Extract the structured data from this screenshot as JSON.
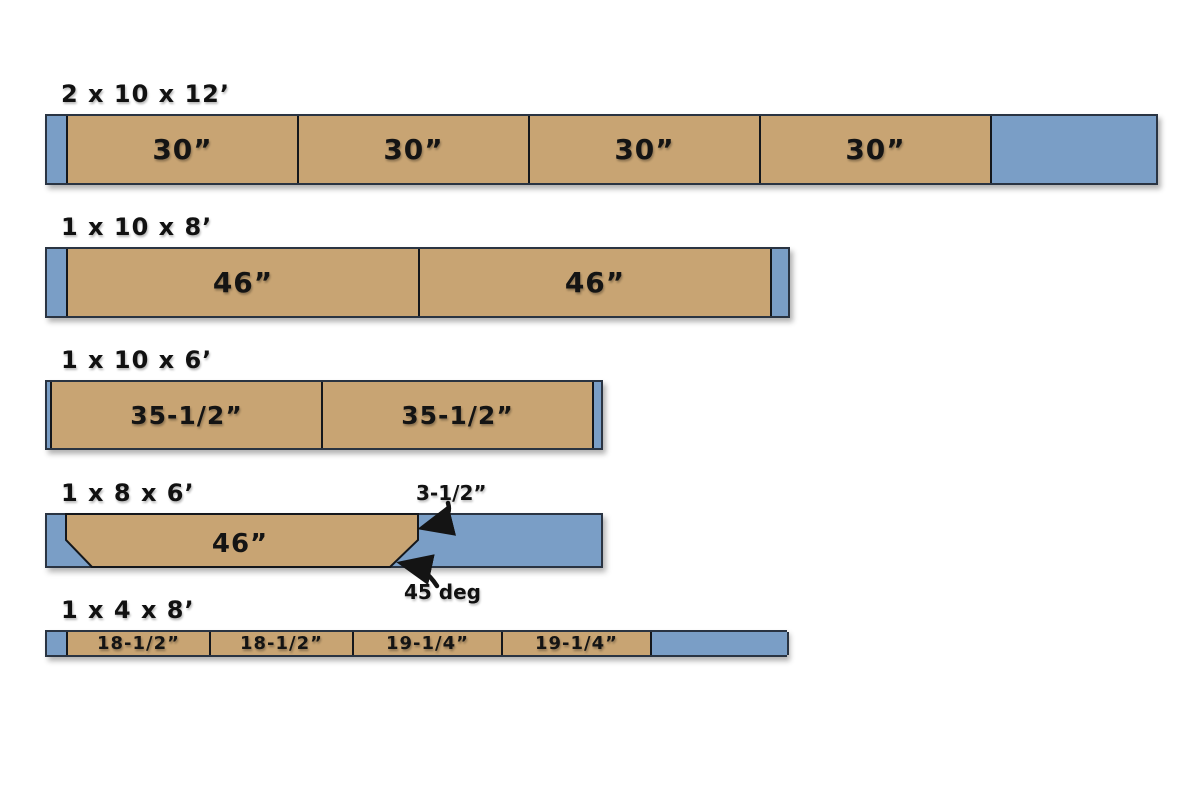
{
  "diagram": {
    "title": "lumber-cut-diagram",
    "colors": {
      "wood": "#c8a473",
      "waste": "#7a9ec6",
      "outline": "#2a3442",
      "divider": "#14171c",
      "text": "#141414"
    },
    "boards": [
      {
        "label": "2 x 10 x 12’",
        "segments": [
          {
            "type": "waste",
            "label": ""
          },
          {
            "type": "wood",
            "label": "30”"
          },
          {
            "type": "wood",
            "label": "30”"
          },
          {
            "type": "wood",
            "label": "30”"
          },
          {
            "type": "wood",
            "label": "30”"
          },
          {
            "type": "waste",
            "label": ""
          }
        ]
      },
      {
        "label": "1 x 10 x 8’",
        "segments": [
          {
            "type": "waste",
            "label": ""
          },
          {
            "type": "wood",
            "label": "46”"
          },
          {
            "type": "wood",
            "label": "46”"
          },
          {
            "type": "waste",
            "label": ""
          }
        ]
      },
      {
        "label": "1 x 10 x 6’",
        "segments": [
          {
            "type": "waste",
            "label": ""
          },
          {
            "type": "wood",
            "label": "35-1/2”"
          },
          {
            "type": "wood",
            "label": "35-1/2”"
          },
          {
            "type": "waste",
            "label": ""
          }
        ]
      },
      {
        "label": "1 x 8 x 6’",
        "piece_label": "46”",
        "annotations": {
          "bevel_width": "3-1/2”",
          "bevel_angle": "45 deg"
        }
      },
      {
        "label": "1 x 4 x 8’",
        "segments": [
          {
            "type": "waste",
            "label": ""
          },
          {
            "type": "wood",
            "label": "18-1/2”"
          },
          {
            "type": "wood",
            "label": "18-1/2”"
          },
          {
            "type": "wood",
            "label": "19-1/4”"
          },
          {
            "type": "wood",
            "label": "19-1/4”"
          },
          {
            "type": "waste",
            "label": ""
          }
        ]
      }
    ]
  }
}
